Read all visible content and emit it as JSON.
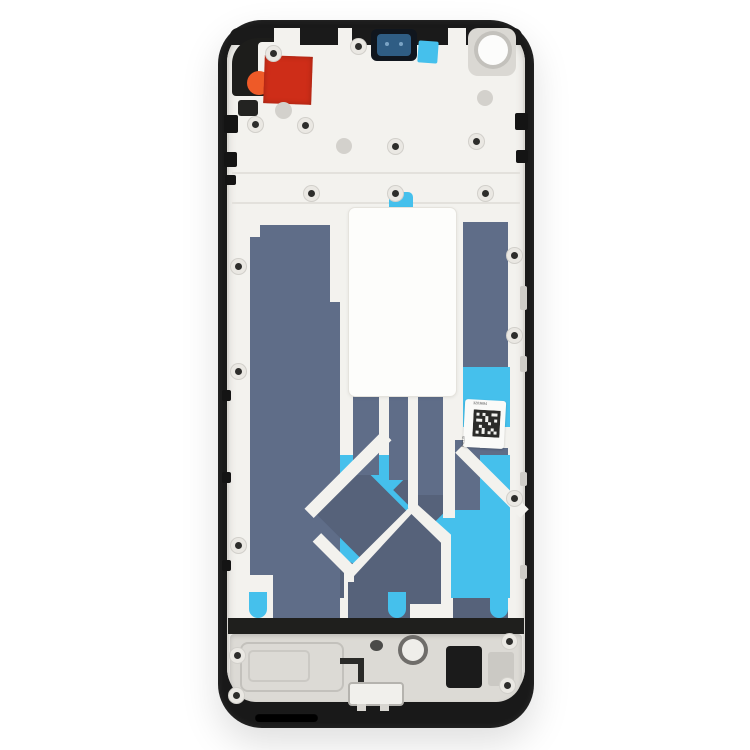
{
  "scene": {
    "description": "E-commerce product photo of a smartphone front housing / middle frame LCD bezel replacement part, shown from the inner side on a plain white background",
    "background_color": "#ffffff"
  },
  "phone_part": {
    "frame_color": "#191919",
    "inner_plate_color": "#f3f2ee",
    "adhesive_dark_color": "#5f6d88",
    "adhesive_cyan_color": "#45c0ec",
    "red_sticker_color": "#ce2d18",
    "orange_pull_tab_color": "#ee5a28",
    "camera_window_color": "#2f5d84",
    "chassis_metal_color": "#dcdad5",
    "parts": [
      {
        "name": "black middle frame with rounded corners"
      },
      {
        "name": "red protective sticker with orange pull tab, top left"
      },
      {
        "name": "front camera module window, top center"
      },
      {
        "name": "small cyan adhesive sticker beside camera"
      },
      {
        "name": "front camera hole plate, top right"
      },
      {
        "name": "white battery-area liner sticker with cyan pull tab"
      },
      {
        "name": "slate-blue graphite adhesive panels"
      },
      {
        "name": "cyan display adhesive maze with white channels"
      },
      {
        "name": "QR serial label sticker on right side"
      },
      {
        "name": "three cyan pull tabs along lower edge"
      },
      {
        "name": "bottom metal chassis with speaker module, screws and USB connector"
      }
    ]
  },
  "stickers": {
    "qr_label": {
      "top_text": "3203694",
      "side_text": "P11115"
    }
  }
}
